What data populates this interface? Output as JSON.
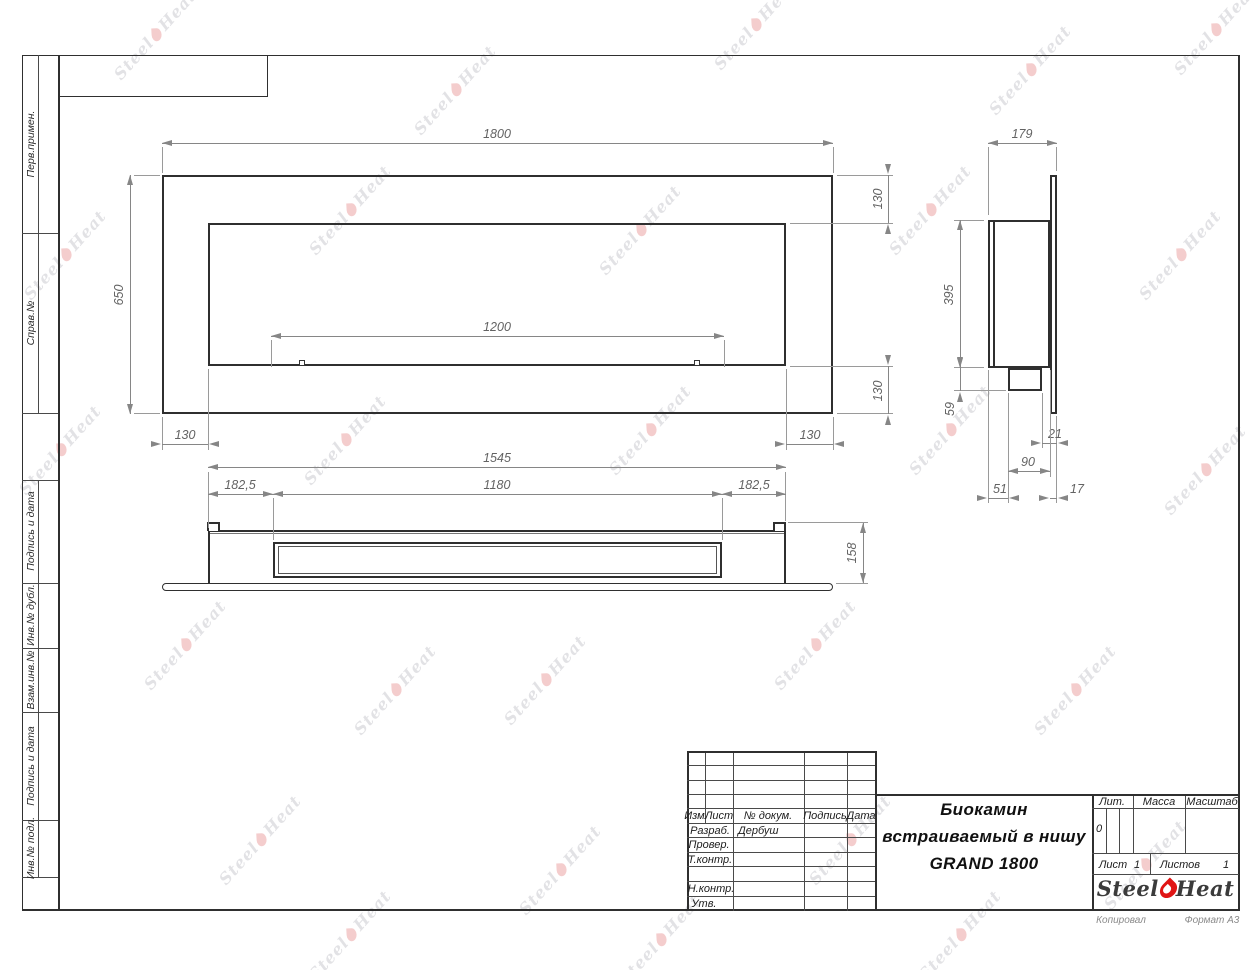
{
  "drawing": {
    "title_lines": [
      "Биокамин",
      "встраиваемый в нишу",
      "GRAND 1800"
    ],
    "developer_name": "Дербуш"
  },
  "strip": {
    "labels": [
      "Перв.примен.",
      "Справ.№",
      "Подпись и дата",
      "Инв.№ дубл.",
      "Взам.инв.№",
      "Подпись и дата",
      "Инв.№ подл."
    ]
  },
  "dims": {
    "front_width": "1800",
    "front_height": "650",
    "front_opening": "1200",
    "front_margin_bottom_left": "130",
    "front_margin_bottom_right": "130",
    "front_margin_right_top": "130",
    "front_margin_right_bottom": "130",
    "side_depth": "179",
    "side_body_height": "395",
    "side_tray_height": "59",
    "side_offset_21": "21",
    "side_tray_width": "90",
    "side_offset_51": "51",
    "side_offset_17": "17",
    "bottom_body_width": "1545",
    "bottom_margin_left": "182,5",
    "bottom_opening_width": "1180",
    "bottom_margin_right": "182,5",
    "bottom_height": "158"
  },
  "title_block": {
    "cols": [
      "Изм.",
      "Лист",
      "№ докум.",
      "Подпись",
      "Дата"
    ],
    "rows": [
      "Разраб.",
      "Провер.",
      "Т.контр.",
      "Н.контр.",
      "Утв."
    ],
    "lit_label": "Лит.",
    "lit_value": "0",
    "mass_label": "Масса",
    "scale_label": "Масштаб",
    "sheet_label": "Лист",
    "sheet_number": "1",
    "sheets_label": "Листов",
    "sheets_total": "1",
    "logo_steel": "Steel",
    "logo_heat": "Heat",
    "copied_label": "Копировал",
    "format_label": "Формат А3"
  },
  "watermark": {
    "steel": "Steel",
    "heat": "Heat",
    "positions": [
      [
        155,
        35
      ],
      [
        455,
        90
      ],
      [
        755,
        25
      ],
      [
        1030,
        70
      ],
      [
        1215,
        30
      ],
      [
        65,
        255
      ],
      [
        350,
        210
      ],
      [
        640,
        230
      ],
      [
        930,
        210
      ],
      [
        1180,
        255
      ],
      [
        60,
        450
      ],
      [
        345,
        440
      ],
      [
        650,
        430
      ],
      [
        950,
        430
      ],
      [
        1205,
        470
      ],
      [
        185,
        645
      ],
      [
        395,
        690
      ],
      [
        545,
        680
      ],
      [
        815,
        645
      ],
      [
        1075,
        690
      ],
      [
        260,
        840
      ],
      [
        560,
        870
      ],
      [
        850,
        840
      ],
      [
        1145,
        865
      ],
      [
        350,
        935
      ],
      [
        660,
        940
      ],
      [
        960,
        935
      ]
    ]
  }
}
